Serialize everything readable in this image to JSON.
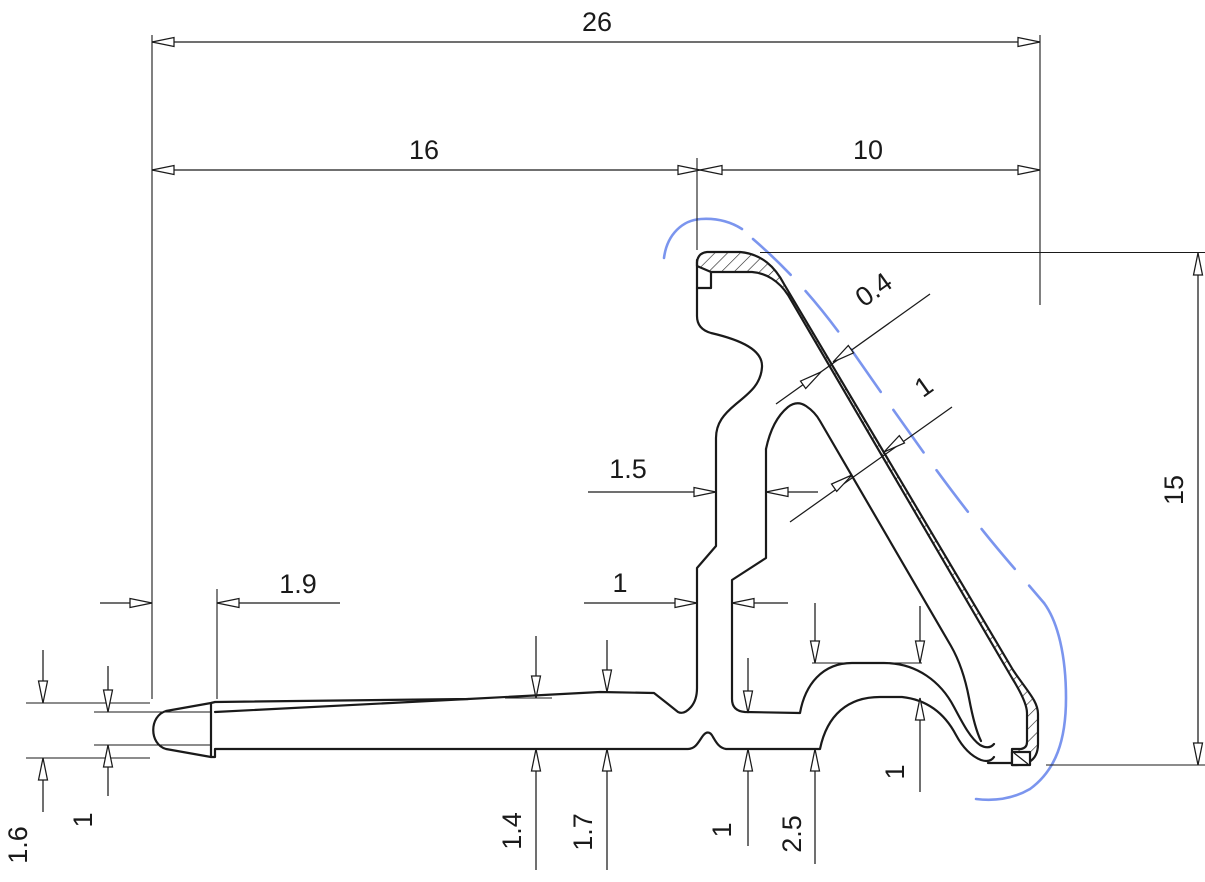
{
  "drawing": {
    "colors": {
      "line": "#1a1a1a",
      "reference": "#7b95ee",
      "background": "#ffffff"
    },
    "dimensions": {
      "overall_width": "26",
      "left_width": "16",
      "right_width": "10",
      "overall_height": "15",
      "tip_step": "1.9",
      "web_upper_thickness": "1.5",
      "web_lower_thickness": "1",
      "lip_thickness": "0.4",
      "lip_gap": "1",
      "tip_outer_height": "1.6",
      "tip_inner_height": "1",
      "arm_thickness_mid": "1.4",
      "arm_thickness_step": "1.7",
      "base_thickness": "1",
      "bulb_height": "2.5",
      "bulb_wall_thickness": "1"
    }
  }
}
